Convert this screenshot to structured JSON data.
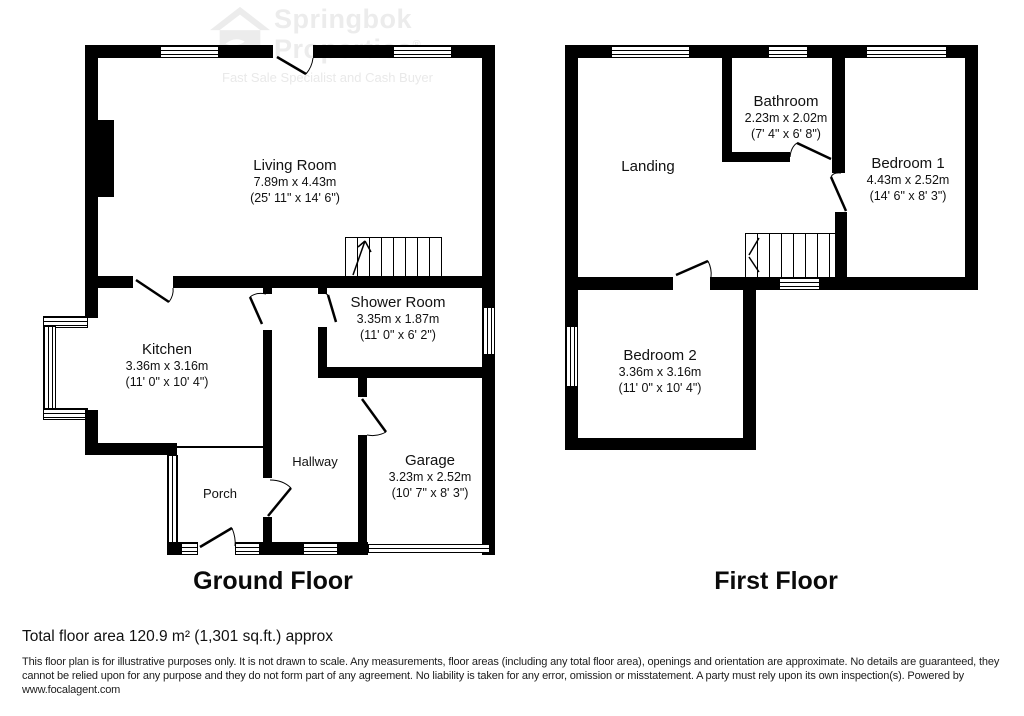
{
  "watermark": {
    "brand_line1": "Springbok",
    "brand_line2": "Properties",
    "registered": "®",
    "tagline": "Fast Sale Specialist and Cash Buyer"
  },
  "floors": {
    "ground": {
      "title": "Ground Floor"
    },
    "first": {
      "title": "First Floor"
    }
  },
  "rooms": {
    "living_room": {
      "name": "Living Room",
      "metric": "7.89m x 4.43m",
      "imperial": "(25' 11\" x 14' 6\")"
    },
    "kitchen": {
      "name": "Kitchen",
      "metric": "3.36m x 3.16m",
      "imperial": "(11' 0\" x 10' 4\")"
    },
    "shower_room": {
      "name": "Shower Room",
      "metric": "3.35m x 1.87m",
      "imperial": "(11' 0\" x 6' 2\")"
    },
    "hallway": {
      "name": "Hallway"
    },
    "porch": {
      "name": "Porch"
    },
    "garage": {
      "name": "Garage",
      "metric": "3.23m x 2.52m",
      "imperial": "(10' 7\" x 8' 3\")"
    },
    "landing": {
      "name": "Landing"
    },
    "bathroom": {
      "name": "Bathroom",
      "metric": "2.23m x 2.02m",
      "imperial": "(7' 4\" x 6' 8\")"
    },
    "bedroom1": {
      "name": "Bedroom 1",
      "metric": "4.43m x 2.52m",
      "imperial": "(14' 6\" x 8' 3\")"
    },
    "bedroom2": {
      "name": "Bedroom 2",
      "metric": "3.36m x 3.16m",
      "imperial": "(11' 0\" x 10' 4\")"
    }
  },
  "footer": {
    "total_area": "Total floor area 120.9 m² (1,301 sq.ft.) approx",
    "disclaimer": "This floor plan is for illustrative purposes only. It is not drawn to scale. Any measurements, floor areas (including any total floor area), openings and orientation are approximate. No details are guaranteed, they cannot be relied upon for any purpose and they do not form part of any agreement. No liability is taken for any error, omission or misstatement. A party must rely upon its own inspection(s). Powered by www.focalagent.com"
  },
  "colors": {
    "wall": "#000000",
    "watermark": "#ececec",
    "text": "#111111"
  }
}
